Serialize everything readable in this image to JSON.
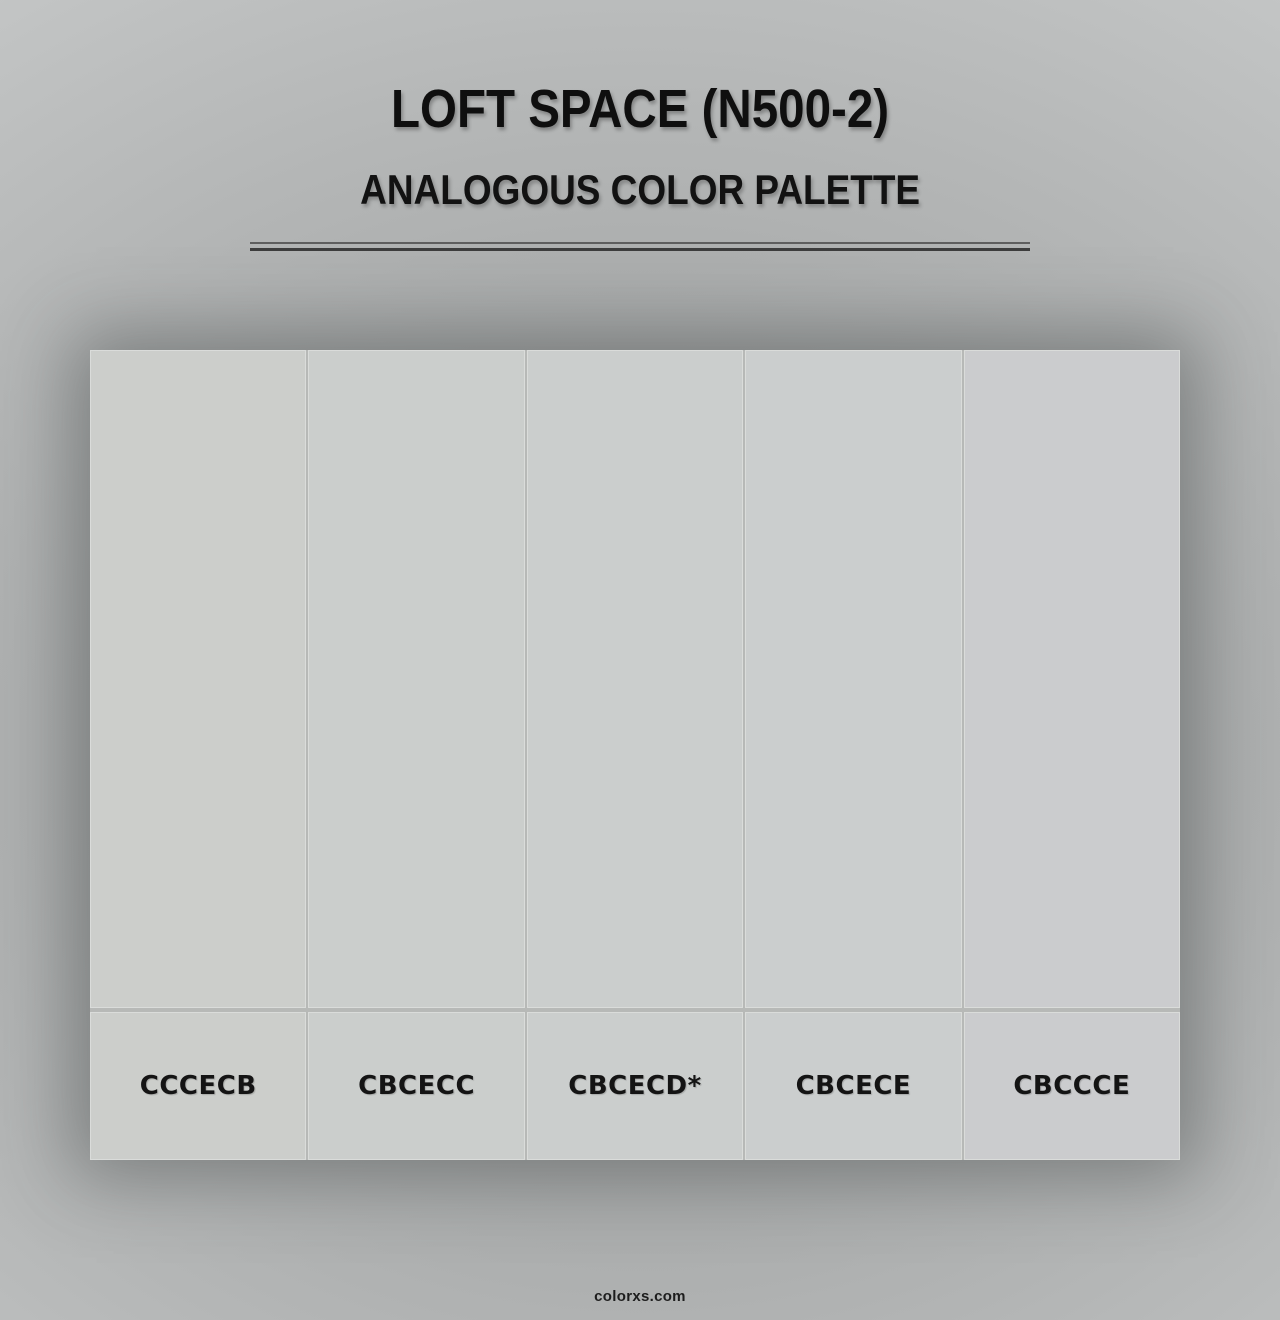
{
  "header": {
    "title": "LOFT SPACE (N500-2)",
    "subtitle": "ANALOGOUS COLOR PALETTE"
  },
  "palette": {
    "type": "analogous",
    "base_marker": "*",
    "swatches": [
      {
        "display": "CCCECB",
        "hex": "#CCCECB",
        "is_base": false
      },
      {
        "display": "CBCECC",
        "hex": "#CBCECC",
        "is_base": false
      },
      {
        "display": "CBCECD*",
        "hex": "#CBCECD",
        "is_base": true
      },
      {
        "display": "CBCECE",
        "hex": "#CBCECE",
        "is_base": false
      },
      {
        "display": "CBCCCE",
        "hex": "#CBCCCE",
        "is_base": false
      }
    ]
  },
  "footer": {
    "brand": "colorxs.com"
  },
  "colors": {
    "page_background_edge": "#c4c6c6",
    "page_background_center": "#9da1a1",
    "heading_text": "#0f0f0f",
    "label_text": "#141414",
    "divider_top": "#5e5e5e",
    "divider_bottom": "#3d3d3d",
    "cell_border": "#dadcda",
    "grid_gap": "#b7b9b7"
  }
}
